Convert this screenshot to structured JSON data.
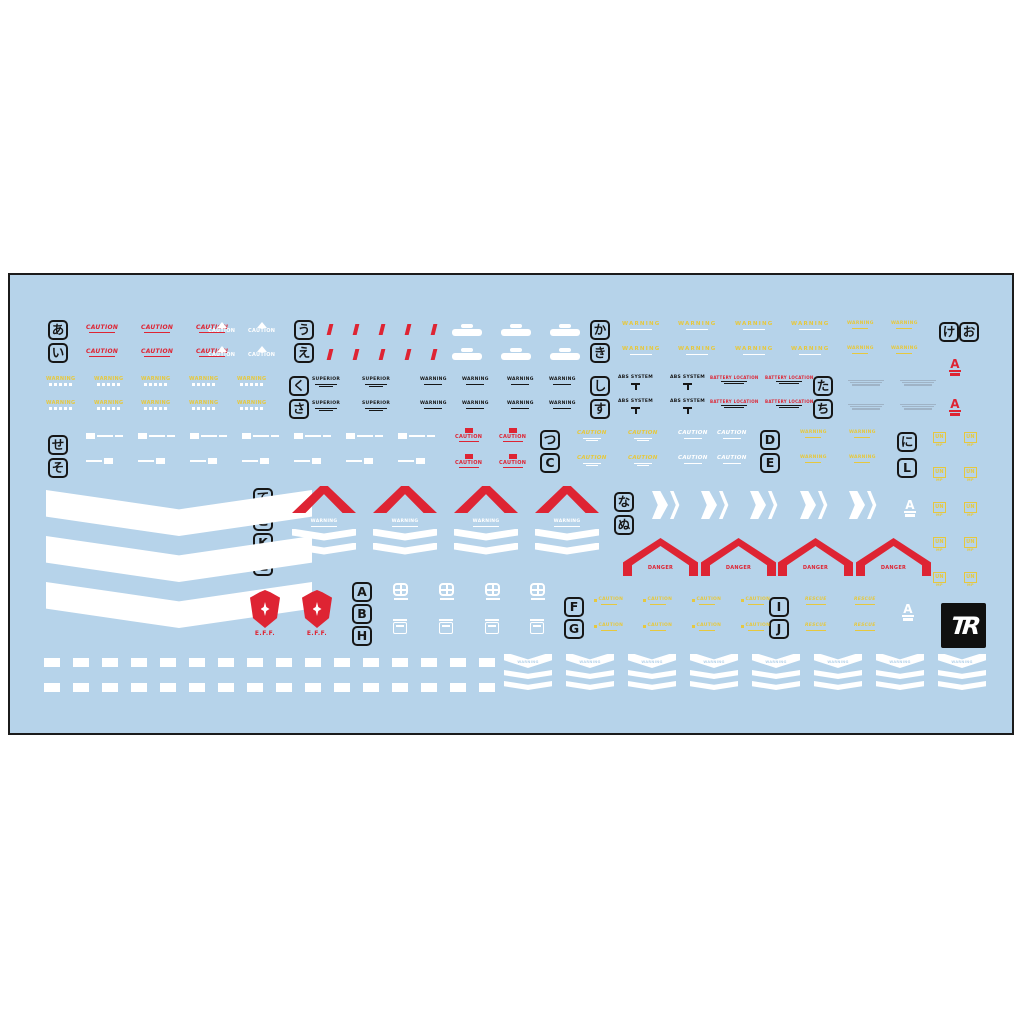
{
  "canvas": {
    "bg": "#ffffff"
  },
  "sheet": {
    "x": 8,
    "y": 273,
    "w": 1006,
    "h": 462,
    "bg": "#b6d3ea",
    "border": "#1b1b1b"
  },
  "palette": {
    "red": "#de2433",
    "yellow": "#e6c83e",
    "white": "#ffffff",
    "black": "#161616",
    "grey": "#9fb3c6",
    "blue": "#b6d3ea"
  },
  "texts": {
    "caution": "CAUTION",
    "warning": "WARNING",
    "danger": "DANGER",
    "eff": "E.F.F.",
    "rescue": "RESCUE",
    "superior": "SUPERIOR",
    "abs_system": "ABS SYSTEM",
    "battery": "BATTERY LOCATION",
    "a": "A",
    "tr": "TR",
    "un": "UN",
    "mp": "MP"
  },
  "markers": [
    {
      "t": "あ",
      "x": 46,
      "y": 318
    },
    {
      "t": "い",
      "x": 46,
      "y": 341
    },
    {
      "t": "う",
      "x": 292,
      "y": 318
    },
    {
      "t": "え",
      "x": 292,
      "y": 341
    },
    {
      "t": "か",
      "x": 588,
      "y": 318
    },
    {
      "t": "き",
      "x": 588,
      "y": 341
    },
    {
      "t": "け",
      "x": 937,
      "y": 320
    },
    {
      "t": "お",
      "x": 957,
      "y": 320
    },
    {
      "t": "く",
      "x": 287,
      "y": 374
    },
    {
      "t": "さ",
      "x": 287,
      "y": 397
    },
    {
      "t": "し",
      "x": 588,
      "y": 374
    },
    {
      "t": "す",
      "x": 588,
      "y": 397
    },
    {
      "t": "た",
      "x": 811,
      "y": 374
    },
    {
      "t": "ち",
      "x": 811,
      "y": 397
    },
    {
      "t": "せ",
      "x": 46,
      "y": 433
    },
    {
      "t": "そ",
      "x": 46,
      "y": 456
    },
    {
      "t": "つ",
      "x": 538,
      "y": 428
    },
    {
      "t": "C",
      "x": 538,
      "y": 451
    },
    {
      "t": "D",
      "x": 758,
      "y": 428
    },
    {
      "t": "E",
      "x": 758,
      "y": 451
    },
    {
      "t": "に",
      "x": 895,
      "y": 430
    },
    {
      "t": "L",
      "x": 895,
      "y": 456
    },
    {
      "t": "て",
      "x": 251,
      "y": 486
    },
    {
      "t": "こ",
      "x": 251,
      "y": 509
    },
    {
      "t": "K",
      "x": 251,
      "y": 531
    },
    {
      "t": "と",
      "x": 251,
      "y": 554
    },
    {
      "t": "な",
      "x": 612,
      "y": 490
    },
    {
      "t": "ぬ",
      "x": 612,
      "y": 513
    },
    {
      "t": "A",
      "x": 350,
      "y": 580
    },
    {
      "t": "B",
      "x": 350,
      "y": 602
    },
    {
      "t": "H",
      "x": 350,
      "y": 624
    },
    {
      "t": "F",
      "x": 562,
      "y": 595
    },
    {
      "t": "G",
      "x": 562,
      "y": 617
    },
    {
      "t": "I",
      "x": 767,
      "y": 595
    },
    {
      "t": "J",
      "x": 767,
      "y": 617
    }
  ],
  "decals": [
    {
      "fn": "redCaution",
      "type": "red-caution-text",
      "xs": [
        84,
        139,
        194
      ],
      "ys": [
        323,
        347
      ]
    },
    {
      "fn": "whiteCautionTri",
      "type": "white-caution-triangle",
      "xs": [
        206,
        246
      ],
      "ys": [
        320,
        344
      ]
    },
    {
      "fn": "redSlash",
      "type": "red-slash-mark",
      "xs": [
        326,
        352,
        378,
        404,
        430
      ],
      "ys": [
        322,
        347
      ]
    },
    {
      "fn": "whiteOval",
      "type": "white-logo",
      "xs": [
        450,
        499,
        548
      ],
      "ys": [
        322,
        346
      ]
    },
    {
      "fn": "yellowWide",
      "type": "yellow-warning-wide",
      "xs": [
        620,
        676,
        733,
        789
      ],
      "ys": [
        320,
        345
      ]
    },
    {
      "fn": "yellowWarnSm",
      "type": "yellow-warning-small",
      "xs": [
        845,
        889
      ],
      "ys": [
        320,
        345
      ]
    },
    {
      "fn": "yellowWave",
      "type": "yellow-warning-wave",
      "xs": [
        44,
        92,
        139,
        187,
        235
      ],
      "ys": [
        375,
        399
      ]
    },
    {
      "fn": "blackSup",
      "type": "black-superior-text",
      "xs": [
        310,
        360
      ],
      "ys": [
        376,
        400
      ]
    },
    {
      "fn": "blackWarn",
      "type": "black-warning-text",
      "xs": [
        418,
        460,
        505,
        547
      ],
      "ys": [
        376,
        400
      ]
    },
    {
      "fn": "absSystem",
      "type": "abs-system-text",
      "xs": [
        616,
        668
      ],
      "ys": [
        374,
        398
      ]
    },
    {
      "fn": "battery",
      "type": "battery-location-text",
      "xs": [
        708,
        763
      ],
      "ys": [
        374,
        398
      ]
    },
    {
      "fn": "greyFine",
      "type": "grey-fineprint",
      "xs": [
        846,
        898
      ],
      "ys": [
        378,
        402
      ]
    },
    {
      "fn": "aLogo",
      "type": "a-emblem-red",
      "color": "#de2433",
      "xs": [
        947
      ],
      "ys": [
        356,
        396
      ]
    },
    {
      "fn": "whiteBarA",
      "type": "white-bar",
      "xs": [
        84,
        136,
        188,
        240,
        292,
        344,
        396
      ],
      "ys": [
        431
      ]
    },
    {
      "fn": "whiteBarB",
      "type": "white-bar",
      "xs": [
        84,
        136,
        188,
        240,
        292,
        344,
        396
      ],
      "ys": [
        456
      ]
    },
    {
      "fn": "redCautionBox",
      "type": "red-caution-box",
      "xs": [
        453,
        497
      ],
      "ys": [
        426,
        452
      ]
    },
    {
      "fn": "yellowCautionSub",
      "type": "yellow-caution",
      "xs": [
        575,
        626
      ],
      "ys": [
        429,
        454
      ]
    },
    {
      "fn": "whiteCautionSub",
      "type": "white-caution-plain",
      "xs": [
        676,
        715
      ],
      "ys": [
        429,
        454
      ]
    },
    {
      "fn": "yellowWarnSm",
      "type": "yellow-warning-small",
      "xs": [
        798,
        847
      ],
      "ys": [
        429,
        454
      ]
    },
    {
      "fn": "unLogo",
      "type": "un-emblem-yellow",
      "xs": [
        931,
        962
      ],
      "ys": [
        430,
        465,
        500,
        535,
        570
      ]
    },
    {
      "fn": "bigChevron",
      "type": "large-white-chevron",
      "w": 266,
      "h": 46,
      "xs": [
        44
      ],
      "ys": [
        488,
        534,
        580
      ]
    },
    {
      "fn": "redChevronUp",
      "type": "red-chevron",
      "w": 64,
      "h": 27,
      "xs": [
        290,
        371,
        452,
        533
      ],
      "ys": [
        484
      ]
    },
    {
      "fn": "warnChevron",
      "type": "white-warning-chevron",
      "w": 64,
      "xs": [
        290,
        371,
        452,
        533
      ],
      "ys": [
        518
      ]
    },
    {
      "fn": "arrowRight",
      "type": "white-double-arrow",
      "xs": [
        650,
        699,
        748,
        798,
        847
      ],
      "ys": [
        489
      ]
    },
    {
      "fn": "aLogo",
      "type": "a-emblem-white",
      "color": "#ffffff",
      "xs": [
        902
      ],
      "ys": [
        497
      ]
    },
    {
      "fn": "dangerHouse",
      "type": "red-danger-chevron",
      "w": 75,
      "h": 38,
      "xs": [
        621,
        699,
        776,
        854
      ],
      "ys": [
        536
      ]
    },
    {
      "fn": "effShield",
      "type": "eff-emblem",
      "xs": [
        248,
        300
      ],
      "ys": [
        588
      ]
    },
    {
      "fn": "emblemGrid",
      "type": "white-grid-emblem",
      "xs": [
        391,
        437,
        483,
        528
      ],
      "ys": [
        581
      ]
    },
    {
      "fn": "emblemBox",
      "type": "white-box-emblem",
      "xs": [
        391,
        437,
        483,
        528
      ],
      "ys": [
        617
      ]
    },
    {
      "fn": "yellowCautionMini",
      "type": "yellow-caution-mini",
      "xs": [
        592,
        641,
        690,
        739
      ],
      "ys": [
        596,
        622
      ]
    },
    {
      "fn": "yellowRescue",
      "type": "yellow-rescue-text",
      "xs": [
        803,
        852
      ],
      "ys": [
        596,
        622
      ]
    },
    {
      "fn": "aLogo",
      "type": "a-emblem-white",
      "color": "#ffffff",
      "xs": [
        900
      ],
      "ys": [
        601
      ]
    },
    {
      "fn": "trLogo",
      "type": "tr-brand-logo",
      "w": 45,
      "h": 45,
      "xs": [
        939
      ],
      "ys": [
        601
      ]
    },
    {
      "fn": "whiteDash",
      "type": "white-dash",
      "x0": 42,
      "count": 16,
      "dx": 29,
      "ys": [
        656,
        681
      ]
    },
    {
      "fn": "warnChevronSm",
      "type": "white-warning-chevron-small",
      "w": 48,
      "x0": 502,
      "count": 8,
      "dx": 62,
      "ys": [
        652
      ]
    }
  ]
}
